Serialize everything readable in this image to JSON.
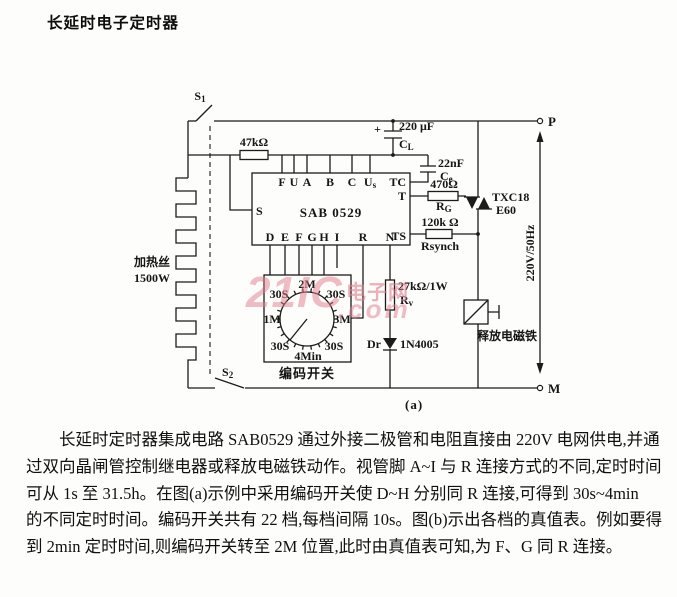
{
  "page": {
    "title": "长延时电子定时器",
    "figure_label": "(a)"
  },
  "colors": {
    "ink": "#1b1b1b",
    "paper": "#fdfdfb",
    "watermark_pink": "#e07c8a"
  },
  "circuit": {
    "switches": {
      "s1": {
        "main": "S",
        "sub": "1"
      },
      "s2": {
        "main": "S",
        "sub": "2"
      }
    },
    "r47k": {
      "value": "47kΩ"
    },
    "heater": {
      "name": "加热丝",
      "power": "1500W"
    },
    "cl": {
      "plus": "+",
      "value": "220 μF",
      "name": "C",
      "name_sub": "L"
    },
    "ce": {
      "value": "22nF",
      "name": "C",
      "name_sub": "e"
    },
    "rg": {
      "value": "470Ω",
      "name": "R",
      "name_sub": "G"
    },
    "rsynch": {
      "value": "120k Ω",
      "name": "Rsynch"
    },
    "rv": {
      "value": "27kΩ/1W",
      "name": "R",
      "name_sub": "v"
    },
    "diode": {
      "name": "Dr",
      "model": "1N4005"
    },
    "triac": {
      "model_line1": "TXC18",
      "model_line2": "E60"
    },
    "magnet": {
      "label": "释放电磁铁"
    },
    "mains": {
      "label": "220V/50Hz",
      "p": "P",
      "m": "M"
    },
    "ic": {
      "name": "SAB 0529",
      "pin_s": "S",
      "pins_top": [
        "F",
        "U",
        "A",
        "B",
        "C"
      ],
      "pin_us": {
        "main": "U",
        "sub": "s"
      },
      "pins_right": [
        "TC",
        "T",
        "TS"
      ],
      "pins_bottom": [
        "D",
        "E",
        "F",
        "G",
        "H",
        "I",
        "R",
        "N"
      ]
    },
    "encoder": {
      "label": "编码开关",
      "positions": {
        "top": "2M",
        "top_left": "30S",
        "top_right": "30S",
        "left": "1M",
        "right": "3M",
        "bottom_left": "30S",
        "bottom_right": "30S",
        "bottom": "4Min"
      }
    }
  },
  "watermark": {
    "text_main": "21IC",
    "text_cn": "电子网",
    "text_domain": ".com"
  },
  "paragraph": {
    "lines": [
      "长延时定时器集成电路 SAB0529 通过外接二极管和电阻直接由 220V 电网供电,并通",
      "过双向晶闸管控制继电器或释放电磁铁动作。视管脚 A~I 与 R 连接方式的不同,定时时间",
      "可从 1s 至 31.5h。在图(a)示例中采用编码开关使 D~H 分别同 R 连接,可得到 30s~4min",
      "的不同定时时间。编码开关共有 22 档,每档间隔 10s。图(b)示出各档的真值表。例如要得",
      "到 2min 定时时间,则编码开关转至 2M 位置,此时由真值表可知,为 F、G 同 R 连接。"
    ]
  }
}
